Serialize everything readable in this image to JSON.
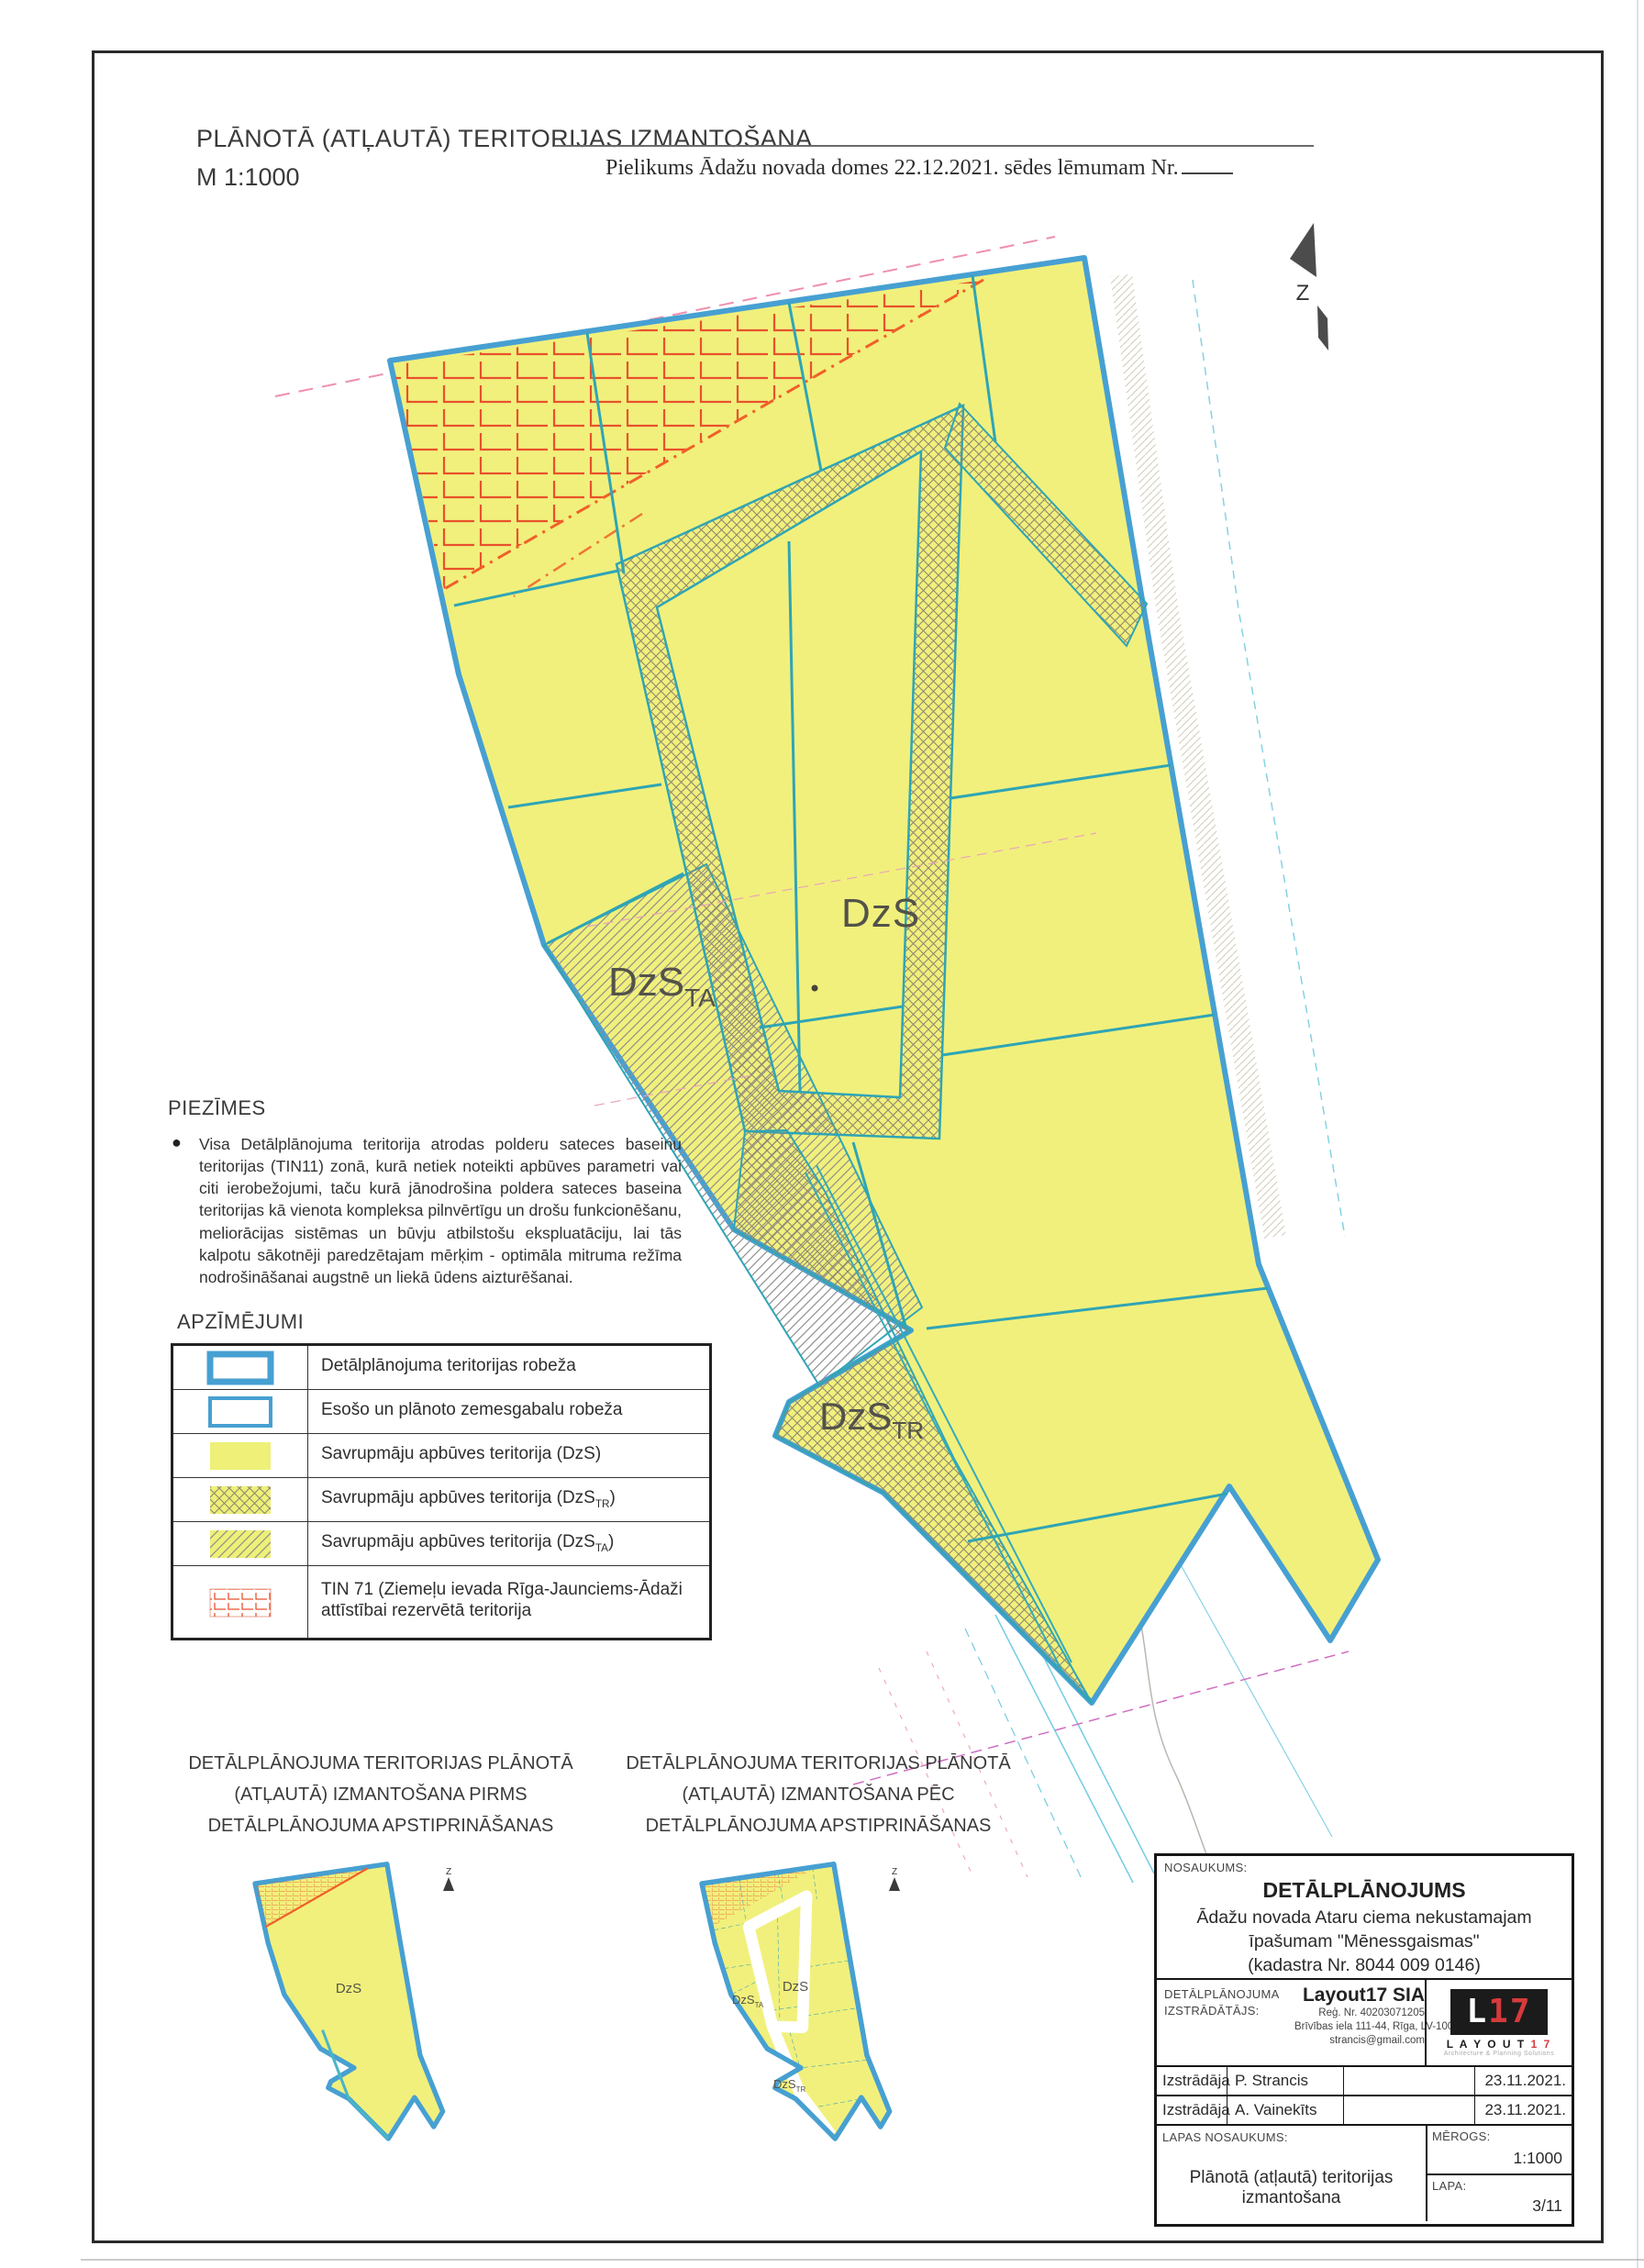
{
  "header": {
    "title": "PLĀNOTĀ (ATĻAUTĀ) TERITORIJAS IZMANTOŠANA",
    "scale": "M 1:1000",
    "annex": "Pielikums Ādažu novada domes 22.12.2021. sēdes lēmumam Nr."
  },
  "north_label": "Z",
  "map_labels": {
    "dzs": "DzS",
    "ta_base": "DzS",
    "ta_sub": "TA",
    "tr_base": "DzS",
    "tr_sub": "TR"
  },
  "notes": {
    "heading": "PIEZĪMES",
    "bullet_text": "Visa Detālplānojuma teritorija atrodas polderu sateces baseinu teritorijas (TIN11) zonā, kurā netiek noteikti apbūves parametri vai citi ierobežojumi, taču kurā jānodrošina poldera sateces baseina teritorijas kā vienota kompleksa pilnvērtīgu un drošu funkcionēšanu, meliorācijas sistēmas un būvju atbilstošu ekspluatāciju, lai tās kalpotu sākotnēji paredzētajam mērķim - optimāla mitruma režīma nodrošināšanai augstnē un liekā ūdens aizturēšanai."
  },
  "legend": {
    "heading": "APZĪMĒJUMI",
    "items": [
      {
        "pre": "Detālplānojuma teritorijas robeža",
        "sub": "",
        "post": ""
      },
      {
        "pre": "Esošo un plānoto zemesgabalu robeža",
        "sub": "",
        "post": ""
      },
      {
        "pre": "Savrupmāju apbūves teritorija (DzS)",
        "sub": "",
        "post": ""
      },
      {
        "pre": "Savrupmāju apbūves teritorija (DzS",
        "sub": "TR",
        "post": ")"
      },
      {
        "pre": "Savrupmāju apbūves teritorija (DzS",
        "sub": "TA",
        "post": ")"
      },
      {
        "pre": "TIN 71 (Ziemeļu ievada Rīga-Jaunciems-Ādaži attīstībai rezervētā teritorija",
        "sub": "",
        "post": ""
      }
    ]
  },
  "small_maps": {
    "left": {
      "lines": [
        "DETĀLPLĀNOJUMA TERITORIJAS PLĀNOTĀ",
        "(ATĻAUTĀ) IZMANTOŠANA PIRMS",
        "DETĀLPLĀNOJUMA APSTIPRINĀŠANAS"
      ]
    },
    "right": {
      "lines": [
        "DETĀLPLĀNOJUMA TERITORIJAS PLĀNOTĀ",
        "(ATĻAUTĀ) IZMANTOŠANA PĒC",
        "DETĀLPLĀNOJUMA APSTIPRINĀŠANAS"
      ]
    }
  },
  "titleblock": {
    "nosaukums_label": "NOSAUKUMS:",
    "project_title": "DETĀLPLĀNOJUMS",
    "project_lines": [
      "Ādažu novada Ataru ciema nekustamajam",
      "īpašumam \"Mēnessgaismas\"",
      "(kadastra Nr. 8044 009 0146)"
    ],
    "developer_label_lines": [
      "DETĀLPLĀNOJUMA",
      "IZSTRĀDĀTĀJS:"
    ],
    "company_name": "Layout17 SIA",
    "company_lines": [
      "Reģ. Nr. 40203071205",
      "Brīvības iela 111-44, Rīga, LV-1001",
      "strancis@gmail.com"
    ],
    "logo": {
      "mark_l": "L",
      "mark_17": "17",
      "wordmark_black": "L A Y O U T",
      "wordmark_red": "1 7",
      "tagline": "Architecture & Planning Solutions"
    },
    "signature_rows": [
      {
        "role": "Izstrādāja",
        "name": "P. Strancis",
        "date": "23.11.2021."
      },
      {
        "role": "Izstrādāja",
        "name": "A. Vainekīts",
        "date": "23.11.2021."
      }
    ],
    "sheet_label": "LAPAS NOSAUKUMS:",
    "sheet_name": "Plānotā (atļautā) teritorijas izmantošana",
    "scale_label": "MĒROGS:",
    "scale_value": "1:1000",
    "page_label": "LAPA:",
    "page_value": "3/11"
  },
  "colors": {
    "boundary_blue": "#47a0d2",
    "parcel_teal": "#2fa5b5",
    "zone_yellow": "#f1f07c",
    "tin_red": "#e8512d",
    "orange_boundary": "#f06028",
    "logo_red": "#d63a3c"
  }
}
